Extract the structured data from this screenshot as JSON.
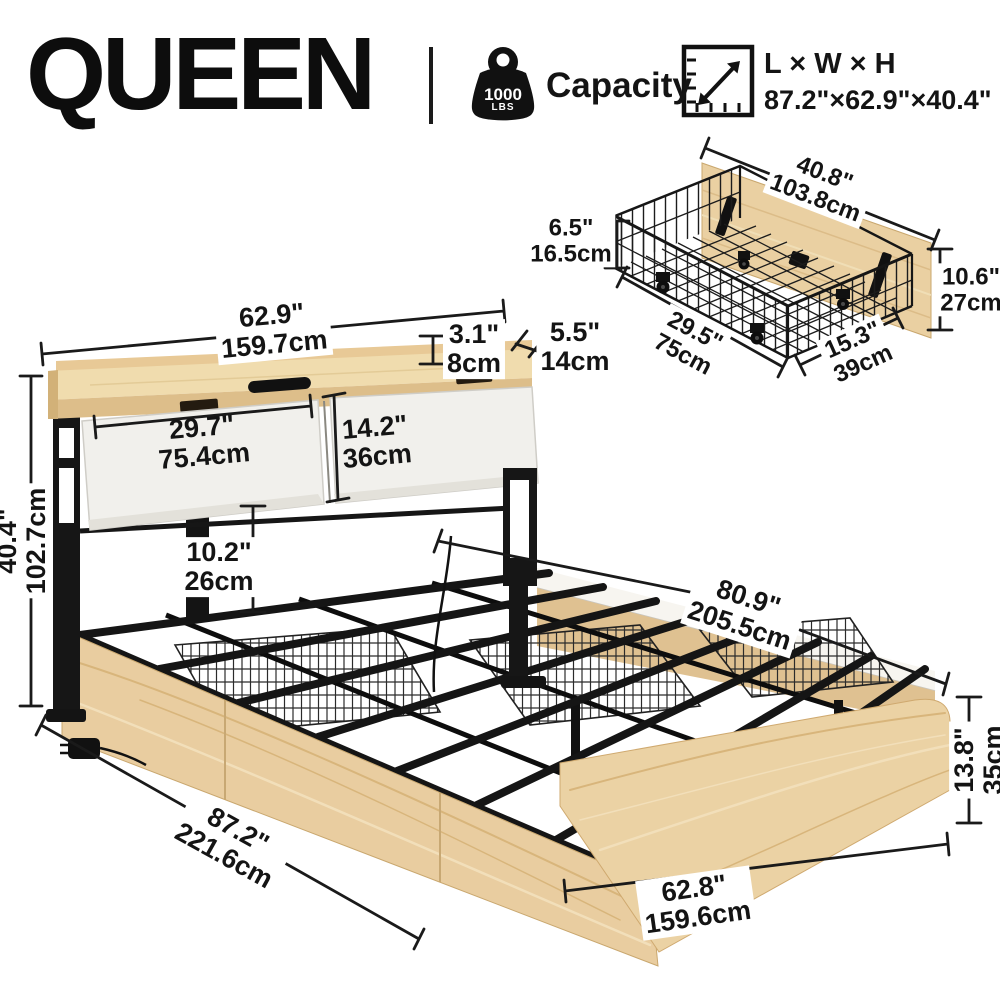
{
  "header": {
    "size_label": "QUEEN",
    "capacity": {
      "value": "1000",
      "unit": "LBS",
      "label": "Capacity"
    },
    "overall": {
      "label": "L × W × H",
      "value": "87.2\"×62.9\"×40.4\""
    },
    "icons": {
      "weight": "weight-icon",
      "ruler": "ruler-dimensions-icon"
    }
  },
  "drawer": {
    "width": {
      "in": "40.8\"",
      "cm": "103.8cm"
    },
    "basket_height": {
      "in": "6.5\"",
      "cm": "16.5cm"
    },
    "panel_height": {
      "in": "10.6\"",
      "cm": "27cm"
    },
    "length": {
      "in": "29.5\"",
      "cm": "75cm"
    },
    "depth": {
      "in": "15.3\"",
      "cm": "39cm"
    }
  },
  "bed": {
    "headboard_width": {
      "in": "62.9\"",
      "cm": "159.7cm"
    },
    "shelf_lip_height": {
      "in": "3.1\"",
      "cm": "8cm"
    },
    "shelf_depth": {
      "in": "5.5\"",
      "cm": "14cm"
    },
    "left_cushion_width": {
      "in": "29.7\"",
      "cm": "75.4cm"
    },
    "cushion_height": {
      "in": "14.2\"",
      "cm": "36cm"
    },
    "under_clearance": {
      "in": "10.2\"",
      "cm": "26cm"
    },
    "total_height": {
      "in": "40.4\"",
      "cm": "102.7cm"
    },
    "rail_length": {
      "in": "80.9\"",
      "cm": "205.5cm"
    },
    "total_length": {
      "in": "87.2\"",
      "cm": "221.6cm"
    },
    "footboard_height": {
      "in": "13.8\"",
      "cm": "35cm"
    },
    "footboard_width": {
      "in": "62.8\"",
      "cm": "159.6cm"
    }
  },
  "colors": {
    "wood": "#e9cda0",
    "wood_dark": "#ddbe8a",
    "wood_light": "#f0dcae",
    "metal": "#161616",
    "cushion": "#f1f0ec",
    "line": "#1a1a1a"
  }
}
